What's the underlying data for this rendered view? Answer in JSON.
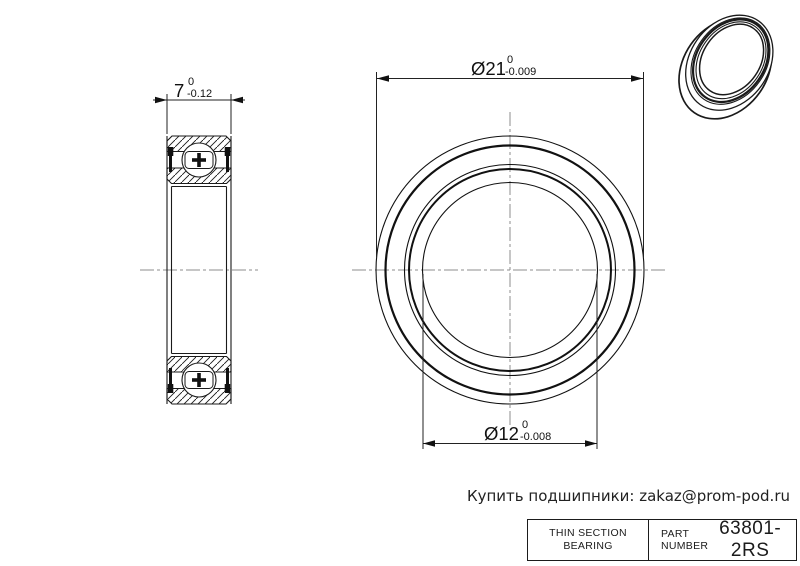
{
  "dimensions": {
    "width": {
      "nominal": "7",
      "tol_upper": "0",
      "tol_lower": "-0.12"
    },
    "outer_diameter": {
      "nominal": "Ø21",
      "tol_upper": "0",
      "tol_lower": "-0.009"
    },
    "bore_diameter": {
      "nominal": "Ø12",
      "tol_upper": "0",
      "tol_lower": "-0.008"
    }
  },
  "footer": {
    "promo_text": "Купить подшипники: zakaz@prom-pod.ru"
  },
  "title_block": {
    "description_line1": "THIN SECTION",
    "description_line2": "BEARING",
    "part_label_line1": "PART",
    "part_label_line2": "NUMBER",
    "part_number": "63801-2RS"
  },
  "colors": {
    "line": "#1a1a1a",
    "centerline": "#8c8c8c",
    "background": "#ffffff"
  }
}
